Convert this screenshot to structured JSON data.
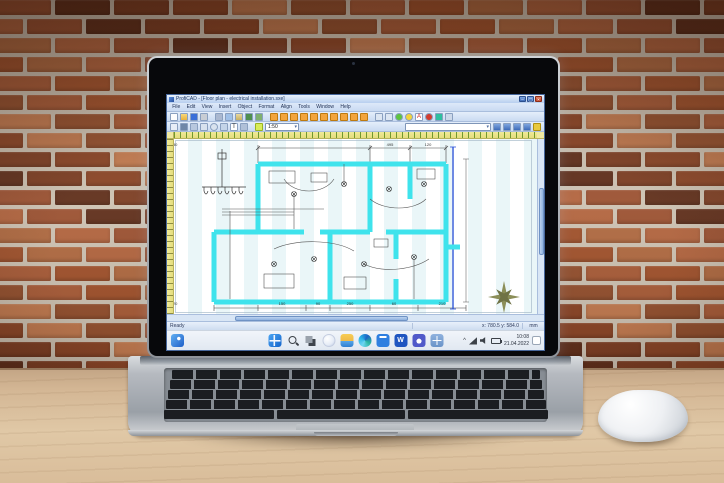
{
  "scene": {
    "wall": {
      "mortar_color": "#cdc3b4",
      "brick_palette": [
        "#9b5233",
        "#8a4527",
        "#a85c39",
        "#b26540",
        "#7c3e24",
        "#93502f",
        "#af6a42",
        "#5f2f1c",
        "#c17a50",
        "#a0522d"
      ]
    },
    "desk_color": "#dcc3a5",
    "laptop_color": "#b7bcc2",
    "mouse_color": "#f4f6f8"
  },
  "app": {
    "titlebar": {
      "title": "ProfiCAD - [Floor plan - electrical installation.sxe]",
      "controls": [
        {
          "n": "minimize-button",
          "t": "–"
        },
        {
          "n": "maximize-button",
          "t": "▢"
        },
        {
          "n": "close-button",
          "t": "×"
        }
      ]
    },
    "menu": {
      "items": [
        "File",
        "Edit",
        "View",
        "Insert",
        "Object",
        "Format",
        "Align",
        "Tools",
        "Window",
        "Help"
      ]
    },
    "toolbar1": {
      "icons": [
        {
          "n": "new-icon",
          "s": "background:#fdfdfd"
        },
        {
          "n": "open-icon",
          "s": "background:linear-gradient(#f8d87a,#e8b23e)"
        },
        {
          "n": "save-icon",
          "s": "background:#3a6fd8"
        },
        {
          "n": "print-icon",
          "s": "background:#c8cdd4"
        },
        {
          "n": "separator",
          "s": "background:none;border:none;width:3px"
        },
        {
          "n": "cut-icon",
          "s": "background:#aab8d0"
        },
        {
          "n": "copy-icon",
          "s": "background:#9fc0e8"
        },
        {
          "n": "paste-icon",
          "s": "background:linear-gradient(#e8d8a0,#c8b060)"
        },
        {
          "n": "undo-icon",
          "s": "background:#4f8f4f"
        },
        {
          "n": "redo-icon",
          "s": "background:#7fb06f"
        },
        {
          "n": "separator",
          "s": "background:none;border:none;width:3px"
        },
        {
          "n": "conductor-button",
          "s": "background:#f2a43c;border-color:#bd7a10"
        },
        {
          "n": "conductor-button",
          "s": "background:#f2a43c;border-color:#bd7a10"
        },
        {
          "n": "conductor-button",
          "s": "background:#f2a43c;border-color:#bd7a10"
        },
        {
          "n": "conductor-button",
          "s": "background:#f2a43c;border-color:#bd7a10"
        },
        {
          "n": "conductor-button",
          "s": "background:#f2a43c;border-color:#bd7a10"
        },
        {
          "n": "conductor-button",
          "s": "background:#f2a43c;border-color:#bd7a10"
        },
        {
          "n": "conductor-button",
          "s": "background:#f2a43c;border-color:#bd7a10"
        },
        {
          "n": "conductor-button",
          "s": "background:#f2a43c;border-color:#bd7a10"
        },
        {
          "n": "conductor-button",
          "s": "background:#f2a43c;border-color:#bd7a10"
        },
        {
          "n": "conductor-button",
          "s": "background:#f2a43c;border-color:#bd7a10"
        },
        {
          "n": "separator",
          "s": "background:none;border:none;width:3px"
        },
        {
          "n": "zoom-in-icon",
          "s": "background:#dce6f2"
        },
        {
          "n": "zoom-out-icon",
          "s": "background:#dce6f2"
        },
        {
          "n": "marker-green-icon",
          "s": "background:#5ec43e;border-radius:50%"
        },
        {
          "n": "marker-yellow-icon",
          "s": "background:#f2d43a;border-radius:50%"
        },
        {
          "n": "text-color-icon",
          "t": "A",
          "s": "background:#fff;color:#c22;font-size:6px;line-height:7px"
        },
        {
          "n": "record-icon",
          "s": "background:#d23c2f;border-radius:50%"
        },
        {
          "n": "layer-icon",
          "s": "background:#2fbf9f"
        },
        {
          "n": "grid-icon",
          "s": "background:#cdd9ea"
        }
      ]
    },
    "toolbar2": {
      "icons": [
        {
          "n": "pointer-icon",
          "s": "background:#e8eef7"
        },
        {
          "n": "wire-tool-icon",
          "s": "background:#6f87a8"
        },
        {
          "n": "line-tool-icon",
          "s": "background:#b8c8de"
        },
        {
          "n": "rect-tool-icon",
          "s": "background:#d8e2ee"
        },
        {
          "n": "circle-tool-icon",
          "s": "background:#d8e2ee;border-radius:50%"
        },
        {
          "n": "arc-tool-icon",
          "s": "background:#c4d4e8"
        },
        {
          "n": "text-tool-icon",
          "t": "T",
          "s": "background:#fff;font-size:6px;line-height:7px"
        },
        {
          "n": "dimension-tool-icon",
          "s": "background:#b0c0d8"
        },
        {
          "n": "separator",
          "s": "background:none;border:none;width:3px"
        },
        {
          "n": "grid-toggle-button",
          "s": "background:#d9ec5a;border-color:#9ab520"
        }
      ],
      "scale_value": "1:50",
      "search_value": "",
      "right_icons": [
        {
          "n": "first-page-button",
          "s": "background:linear-gradient(#7fa6e0,#3f6cb8)"
        },
        {
          "n": "previous-page-button",
          "s": "background:linear-gradient(#7fa6e0,#3f6cb8)"
        },
        {
          "n": "next-page-button",
          "s": "background:linear-gradient(#7fa6e0,#3f6cb8)"
        },
        {
          "n": "last-page-button",
          "s": "background:linear-gradient(#7fa6e0,#3f6cb8)"
        },
        {
          "n": "bookmark-icon",
          "s": "background:#e8c93e;border-color:#b09010"
        }
      ]
    },
    "statusbar": {
      "left": "Ready",
      "coords": "x: 780.5   y: 584.0",
      "units": "mm"
    },
    "canvas": {
      "accent_cyan": "#3fe3ec",
      "top_dims": [
        "495",
        "120",
        "330"
      ],
      "bottom_dims": [
        "150",
        "90",
        "250",
        "60",
        "210",
        "120"
      ],
      "elements": [
        "distribution-board",
        "outer-walls",
        "partition-walls",
        "wiring",
        "ceiling-lamps",
        "dimension-chains",
        "compass-rose"
      ]
    }
  },
  "taskbar": {
    "left_icons": [
      {
        "n": "widgets-icon"
      }
    ],
    "center_icons": [
      {
        "n": "start-icon"
      },
      {
        "n": "search-icon"
      },
      {
        "n": "task-view-icon"
      },
      {
        "n": "copilot-icon"
      },
      {
        "n": "file-explorer-icon"
      },
      {
        "n": "edge-icon"
      },
      {
        "n": "store-icon"
      },
      {
        "n": "word-icon",
        "t": "W"
      },
      {
        "n": "teams-icon"
      },
      {
        "n": "app-window-icon"
      }
    ],
    "tray": {
      "chevron": "^",
      "glyphs": [
        {
          "n": "chevron-up-icon",
          "t": "^"
        },
        {
          "n": "network-icon"
        },
        {
          "n": "volume-icon"
        },
        {
          "n": "battery-icon"
        }
      ],
      "time": "10:08",
      "date": "21.04.2022"
    }
  }
}
